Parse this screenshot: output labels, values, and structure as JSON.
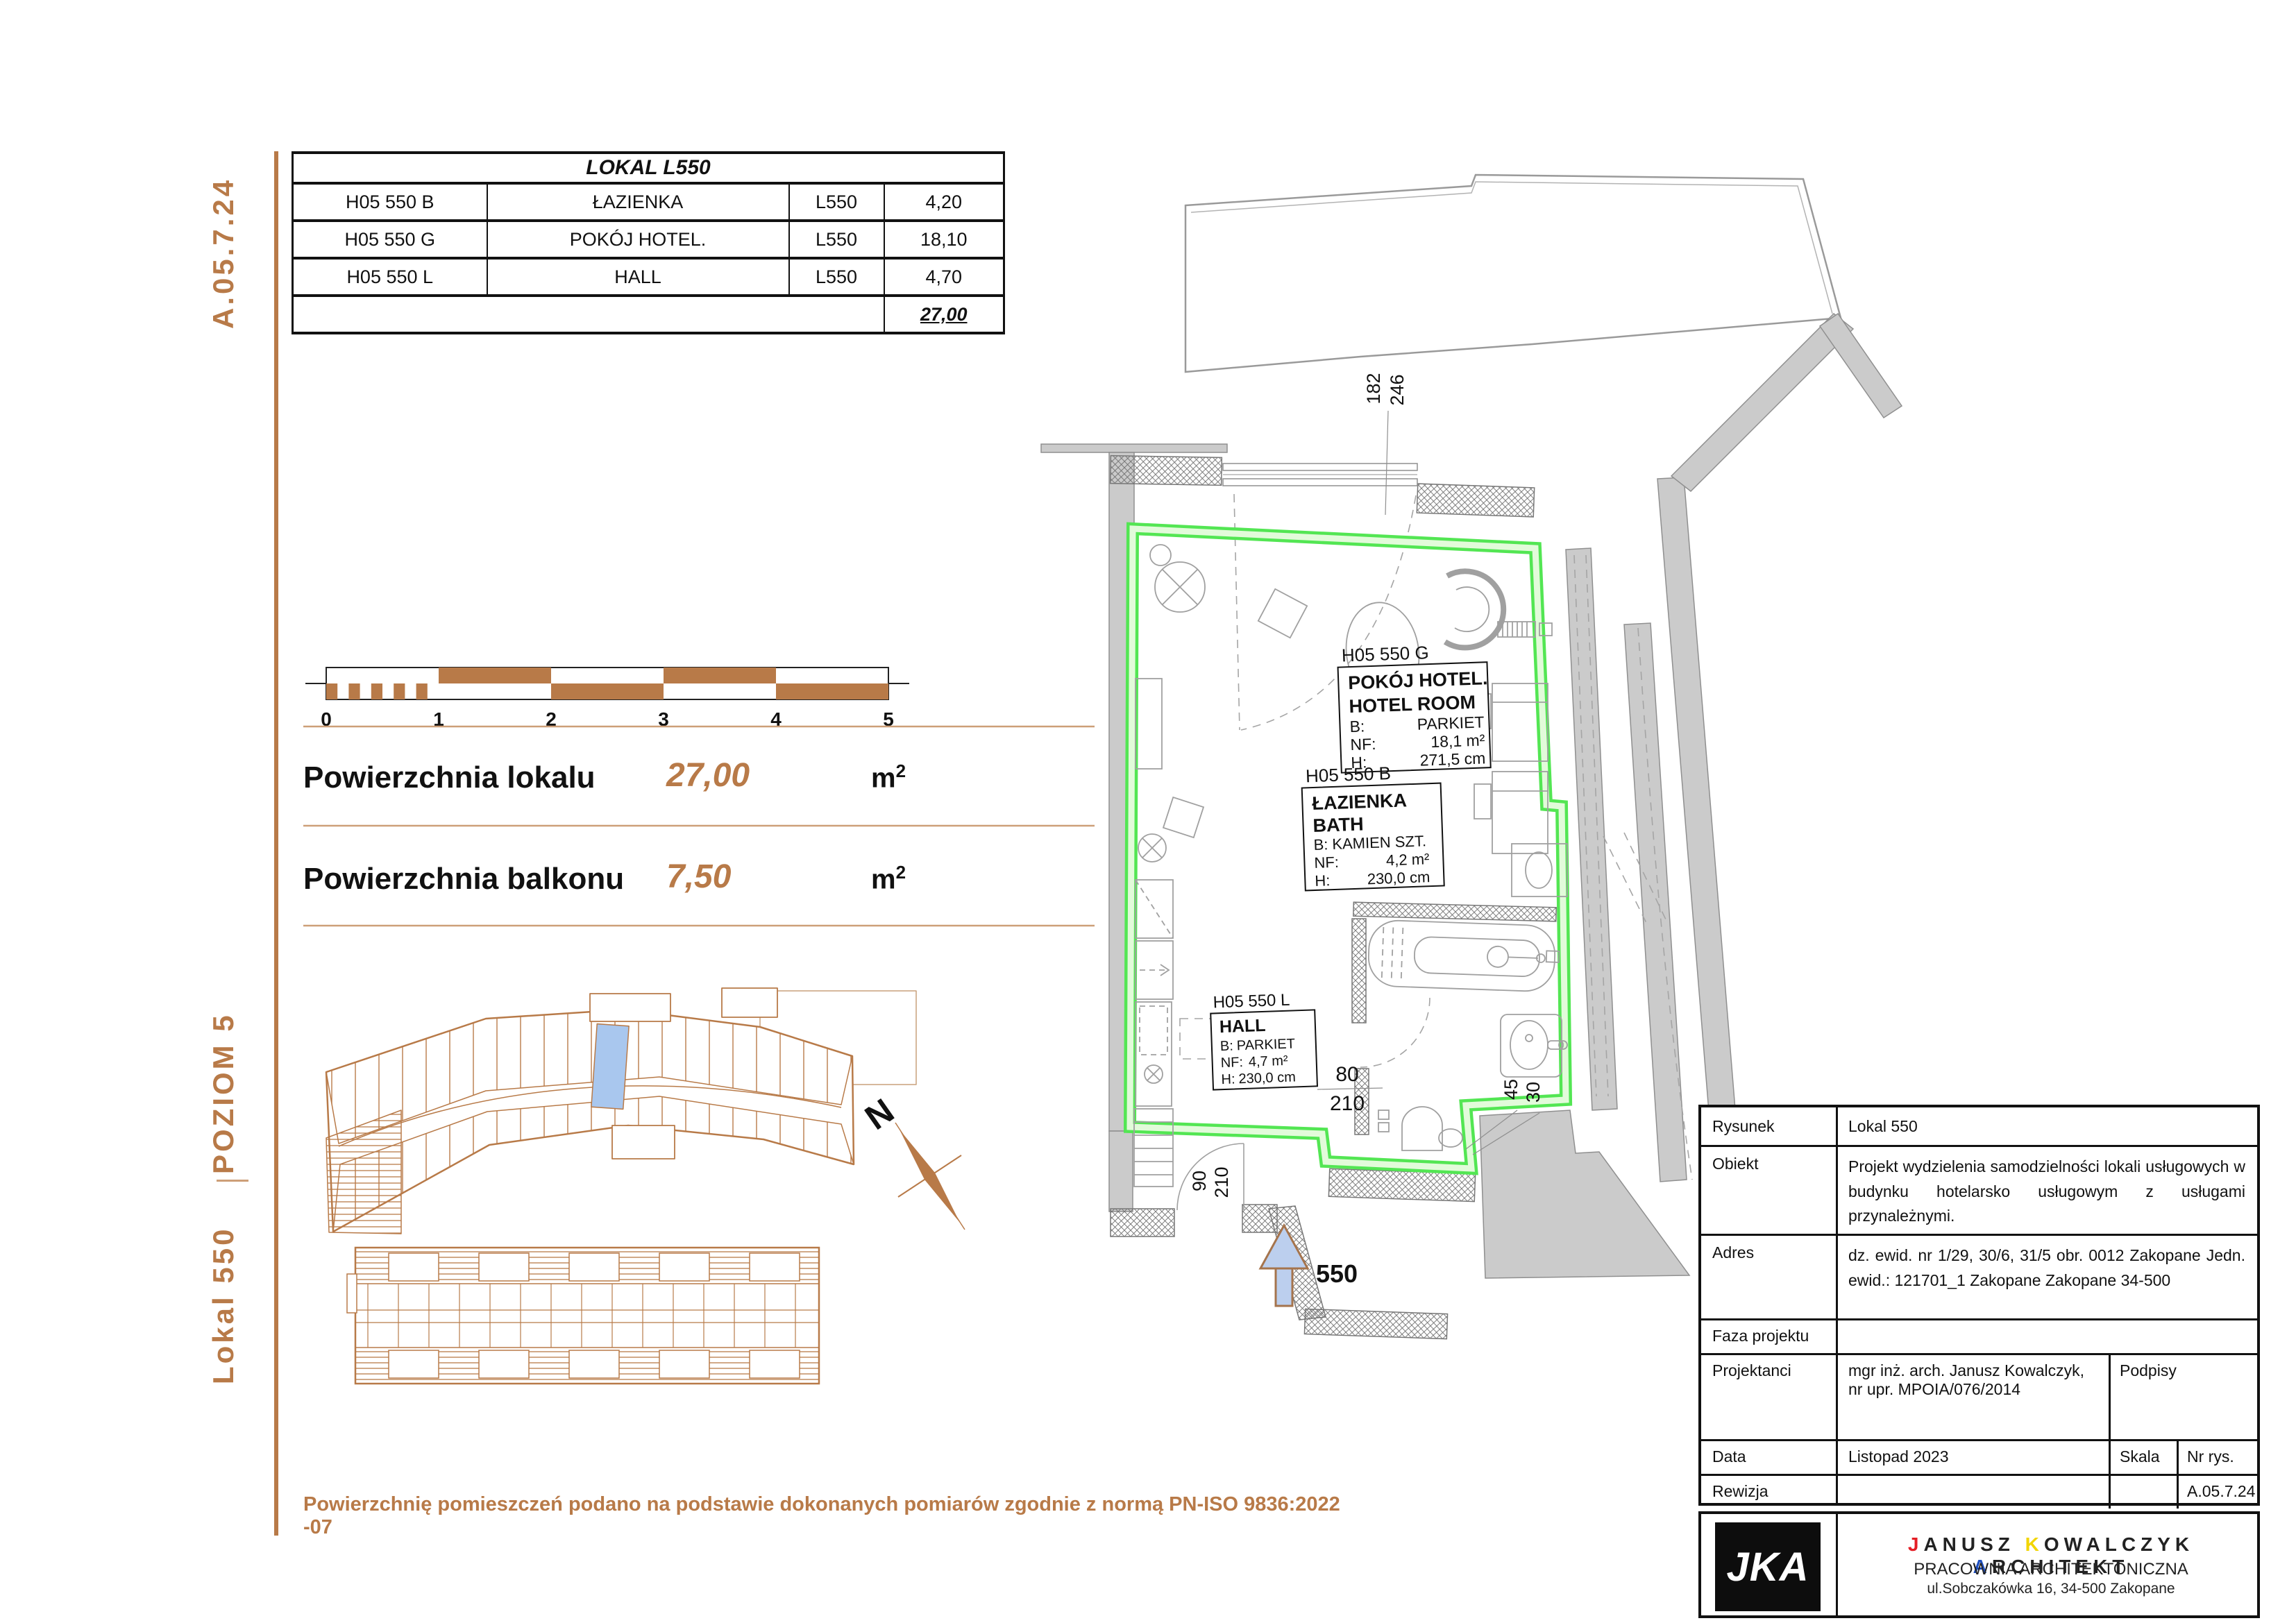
{
  "colors": {
    "brown": "#b87a48",
    "green_edge": "#53e653",
    "green_fill": "#e2fbda",
    "wall_gray": "#cbcbcb",
    "blue_highlight": "#a9c7ee",
    "logo_red": "#e41e25",
    "logo_yellow": "#f2d500",
    "logo_blue": "#1f4fbf"
  },
  "sidebar": {
    "doc_code": "A.05.7.24",
    "level": "POZIOM 5",
    "unit": "Lokal 550"
  },
  "lokal_table": {
    "title": "LOKAL L550",
    "rows": [
      {
        "id": "H05 550 B",
        "name": "ŁAZIENKA",
        "lokal": "L550",
        "area": "4,20"
      },
      {
        "id": "H05 550 G",
        "name": "POKÓJ HOTEL.",
        "lokal": "L550",
        "area": "18,10"
      },
      {
        "id": "H05 550 L",
        "name": "HALL",
        "lokal": "L550",
        "area": "4,70"
      }
    ],
    "total": "27,00"
  },
  "scalebar": {
    "ticks": [
      "0",
      "1",
      "2",
      "3",
      "4",
      "5"
    ]
  },
  "areas": {
    "local_label": "Powierzchnia lokalu",
    "local_value": "27,00",
    "balcony_label": "Powierzchnia balkonu",
    "balcony_value": "7,50",
    "unit": "m",
    "unit_sup": "2"
  },
  "north_label": "N",
  "plan": {
    "room_hotel": {
      "id": "H05 550 G",
      "name_pl": "POKÓJ HOTEL.",
      "name_en": "HOTEL ROOM",
      "b_label": "B:",
      "b": "PARKIET",
      "nf_label": "NF:",
      "nf": "18,1 m²",
      "h_label": "H:",
      "h": "271,5 cm"
    },
    "room_bath": {
      "id": "H05 550 B",
      "name_pl": "ŁAZIENKA",
      "name_en": "BATH",
      "b_label": "B:",
      "b": "KAMIEN SZT.",
      "nf_label": "NF:",
      "nf": "4,2 m²",
      "h_label": "H:",
      "h": "230,0 cm"
    },
    "room_hall": {
      "id": "H05 550 L",
      "name_pl": "HALL",
      "b_label": "B:",
      "b": "PARKIET",
      "nf_label": "NF:",
      "nf": "4,7 m²",
      "h_label": "H:",
      "h": "230,0 cm"
    },
    "dims": {
      "window_w": "182",
      "window_h": "246",
      "door_w": "80",
      "door_h": "210",
      "entry_w": "90",
      "entry_h": "210",
      "niche_w": "45",
      "niche_d": "30"
    },
    "entry_label": "550"
  },
  "footer_note": "Powierzchnię pomieszczeń podano na podstawie dokonanych pomiarów zgodnie z normą PN-ISO 9836:2022 -07",
  "titleblock": {
    "rysunek_label": "Rysunek",
    "rysunek": "Lokal 550",
    "obiekt_label": "Obiekt",
    "obiekt": "Projekt wydzielenia samodzielności lokali usługowych w budynku hotelarsko usługowym z usługami przynależnymi.",
    "adres_label": "Adres",
    "adres": "dz. ewid. nr 1/29, 30/6, 31/5 obr. 0012 Zakopane Jedn. ewid.: 121701_1 Zakopane Zakopane 34-500",
    "faza_label": "Faza projektu",
    "projektanci_label": "Projektanci",
    "projektanci": "mgr inż. arch. Janusz Kowalczyk, nr upr. MPOIA/076/2014",
    "podpisy_label": "Podpisy",
    "data_label": "Data",
    "data": "Listopad 2023",
    "skala_label": "Skala",
    "nr_label": "Nr rys.",
    "rewizja_label": "Rewizja",
    "nr_value": "A.05.7.24"
  },
  "logo": {
    "initials": "JKA",
    "n1": "J",
    "n2": "ANUSZ",
    "n3": "K",
    "n4": "OWALCZYK",
    "n5": "A",
    "n6": "RCHITEKT",
    "line2": "PRACOWNIA ARCHITEKTONICZNA",
    "line3": "ul.Sobczakówka 16, 34-500 Zakopane"
  }
}
